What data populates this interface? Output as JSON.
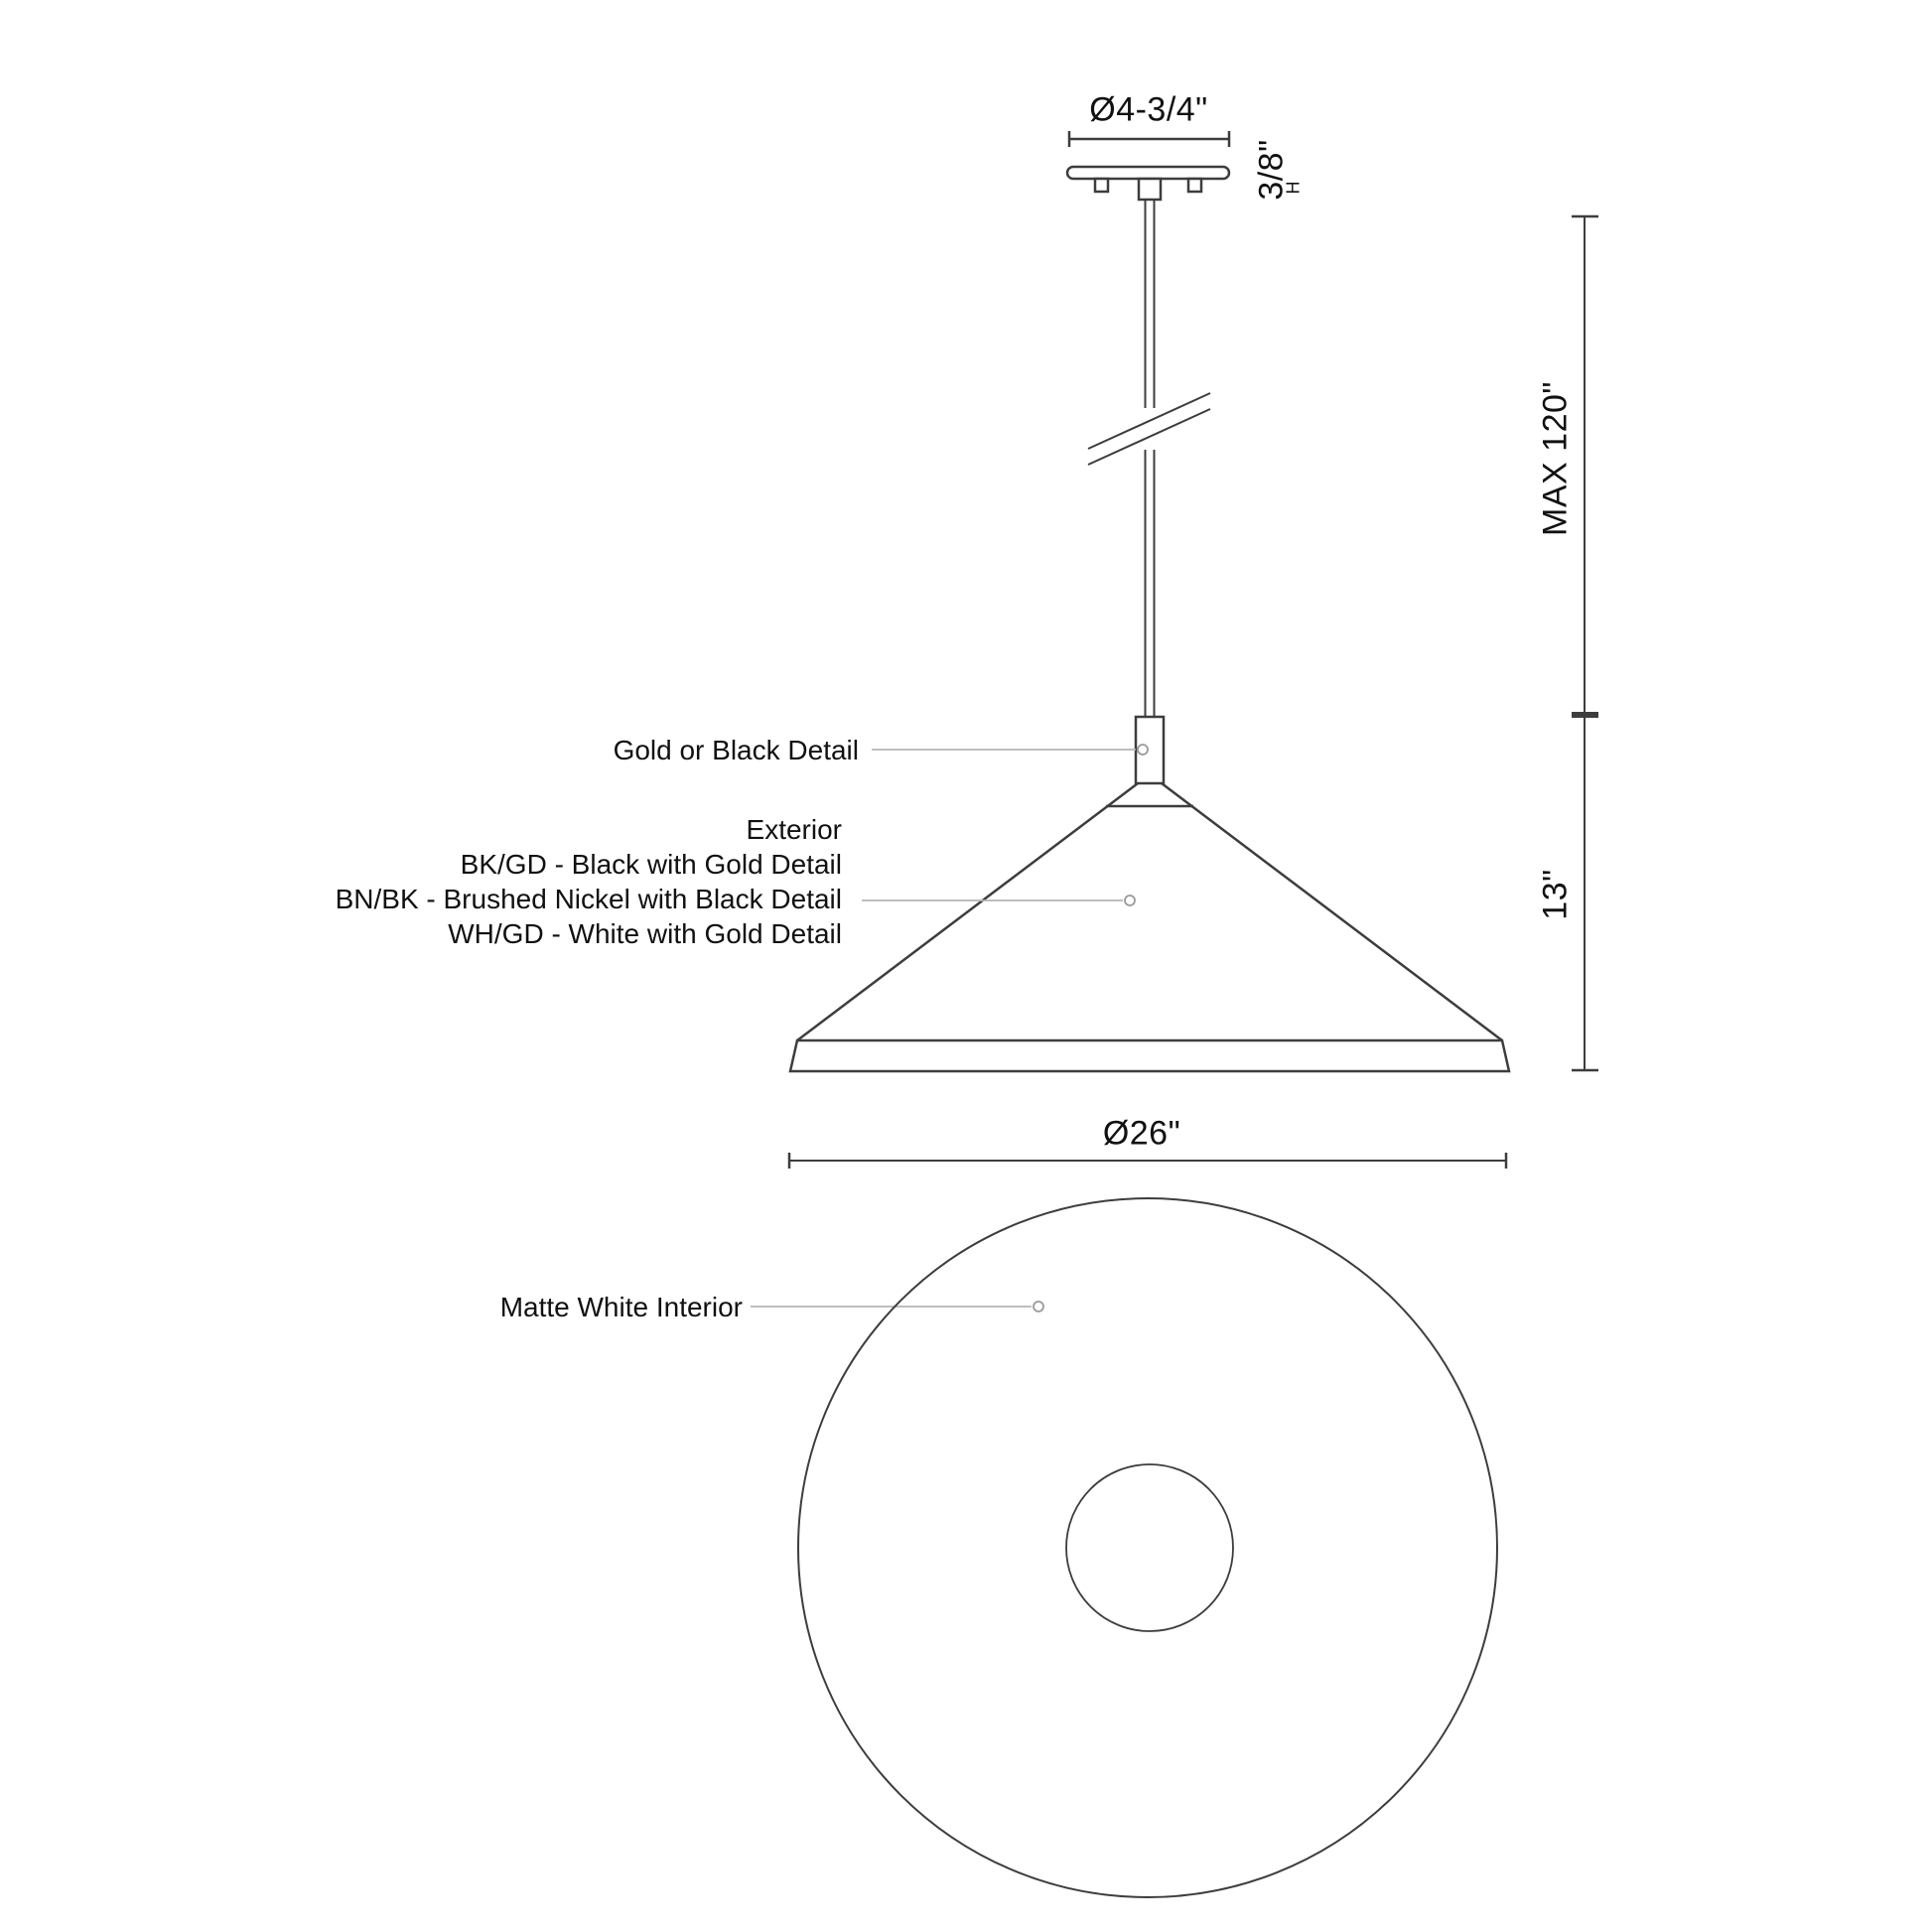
{
  "dims": {
    "canopy_diameter": "Ø4-3/4\"",
    "canopy_height": "3/8\"",
    "canopy_height_marker": "H",
    "max_suspension": "MAX 120\"",
    "shade_height": "13\"",
    "shade_diameter": "Ø26\""
  },
  "labels": {
    "stem_detail": "Gold or Black Detail",
    "exterior_heading": "Exterior",
    "exterior_options": [
      "BK/GD - Black with Gold Detail",
      "BN/BK - Brushed Nickel with Black Detail",
      "WH/GD - White with Gold Detail"
    ],
    "interior": "Matte White Interior"
  },
  "colors": {
    "background": "#ffffff",
    "line": "#3d3d3d",
    "text": "#111111",
    "leader": "#b5b5b5",
    "leader_dot": "#9a9a9a"
  }
}
